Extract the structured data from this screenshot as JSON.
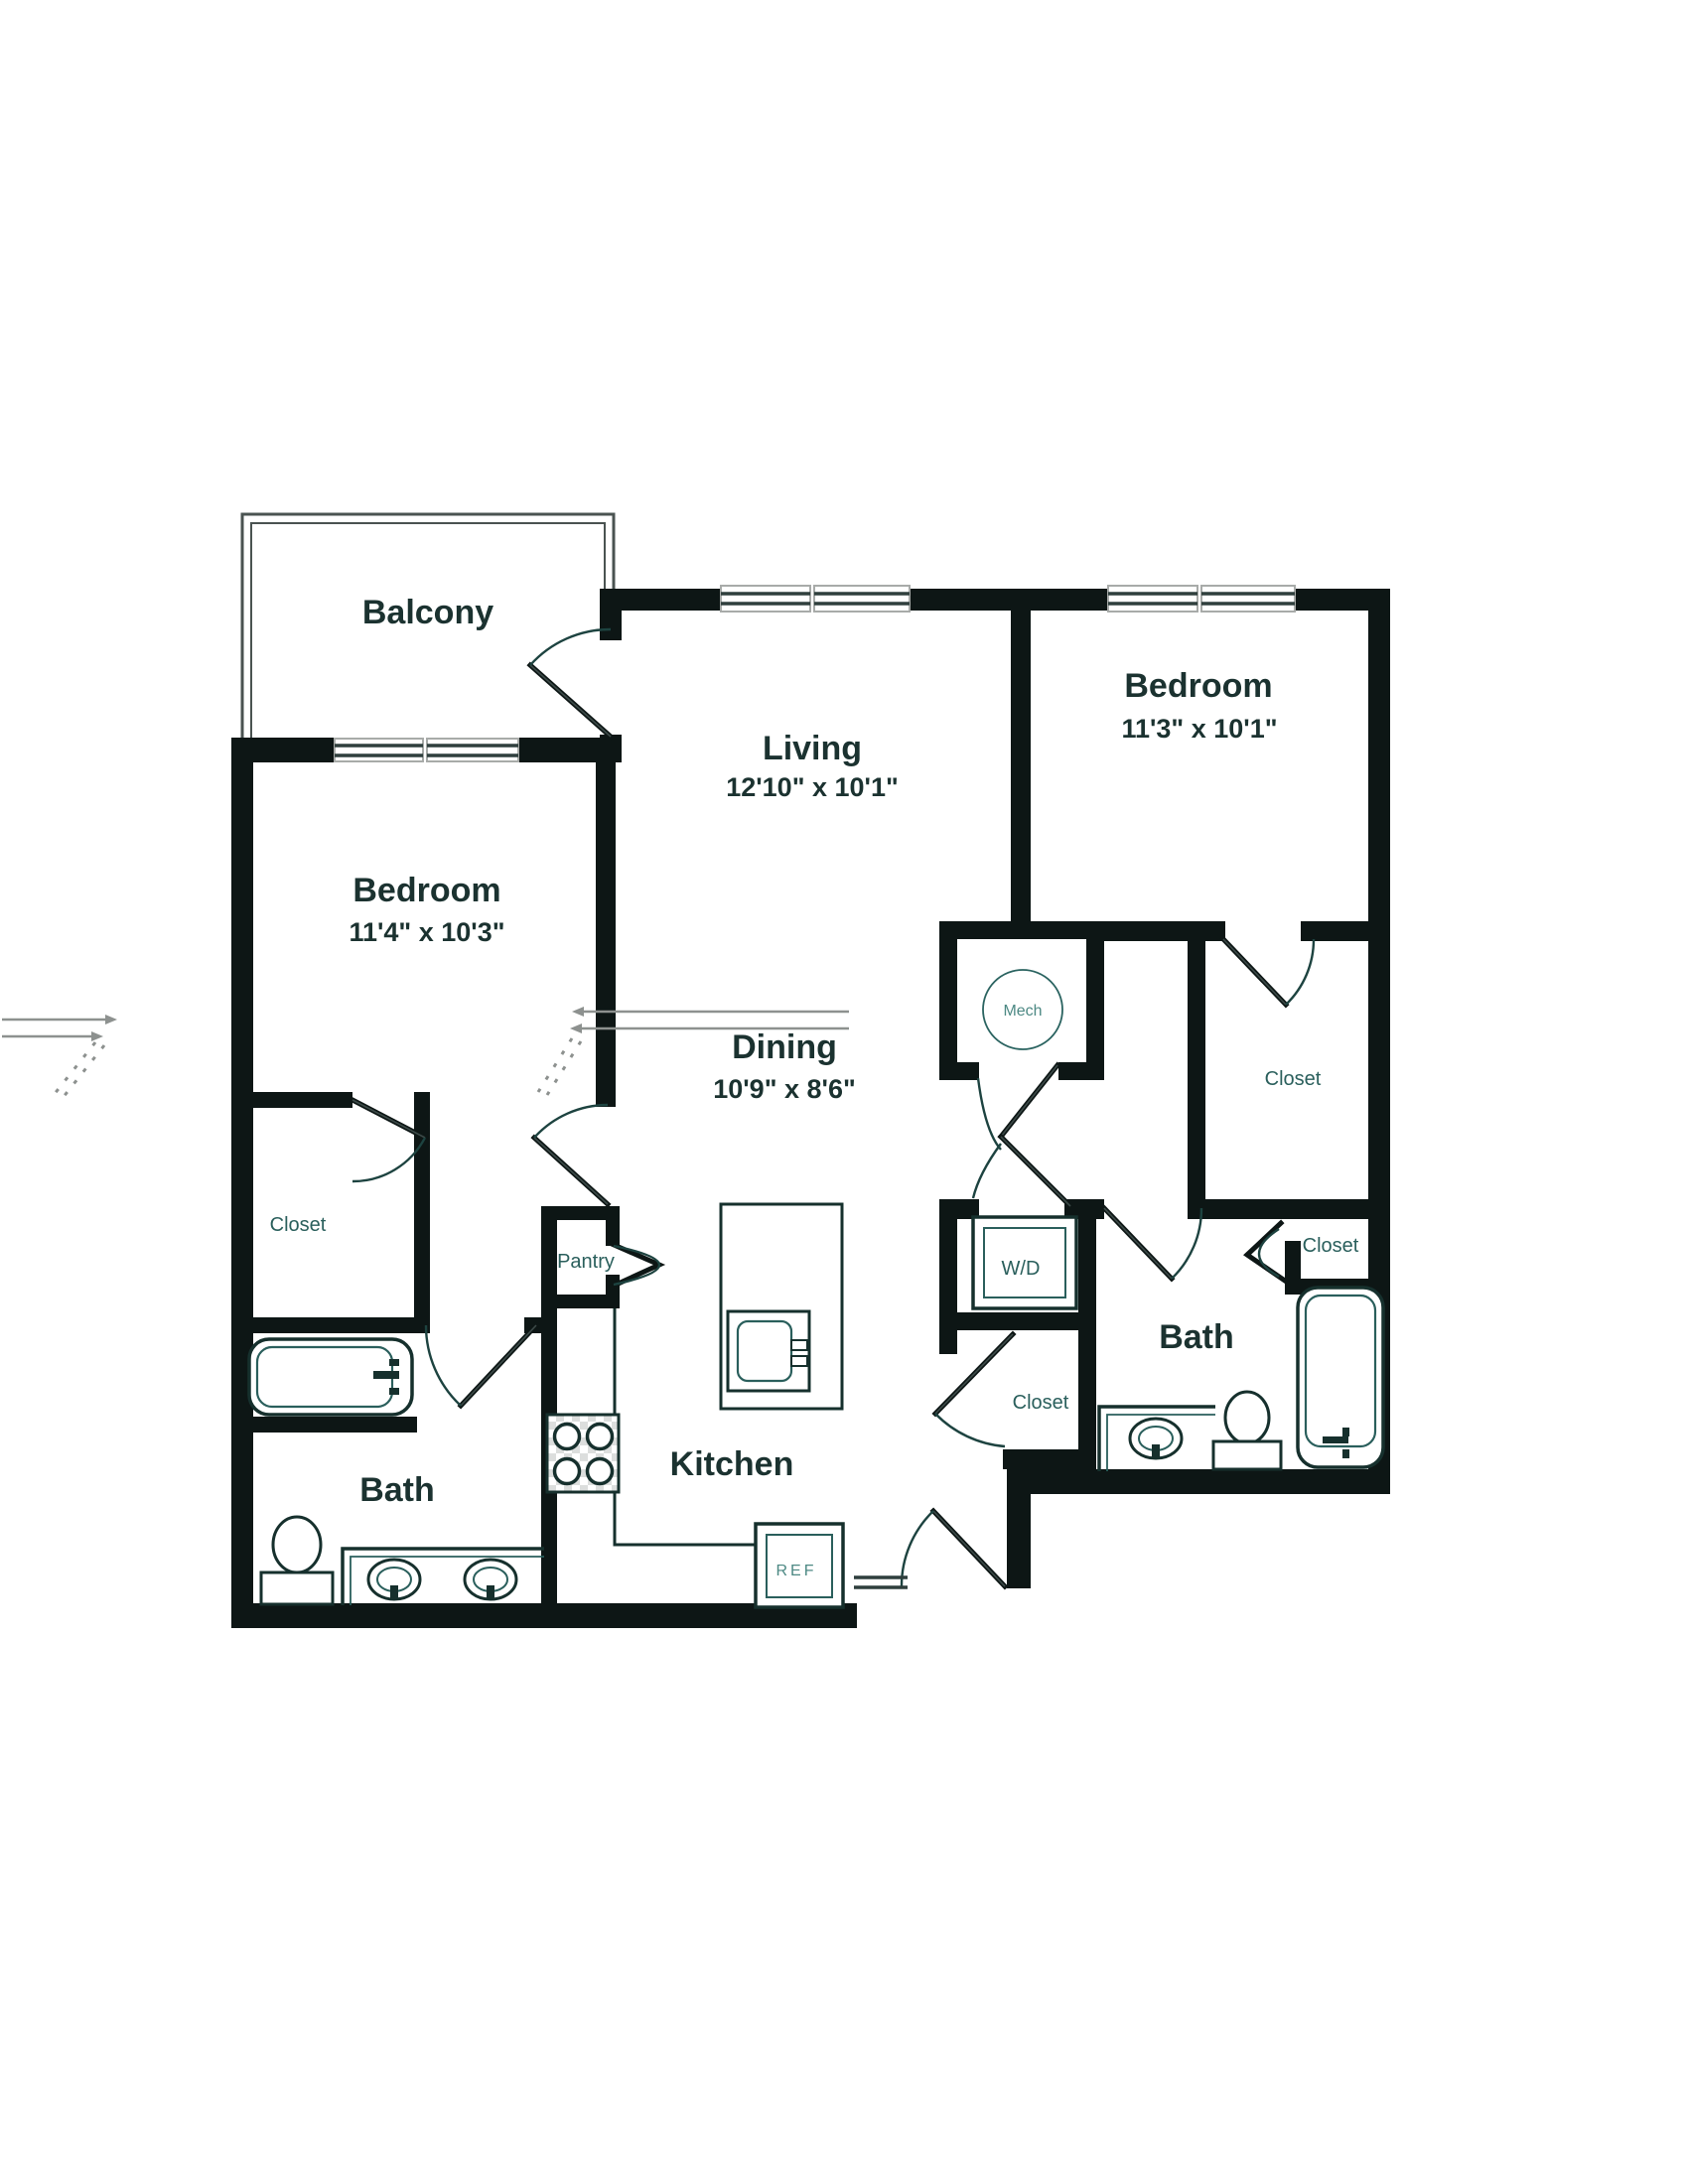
{
  "rooms": {
    "balcony": {
      "name": "Balcony"
    },
    "living": {
      "name": "Living",
      "dims": "12'10\" x 10'1\""
    },
    "bedroom_right": {
      "name": "Bedroom",
      "dims": "11'3\" x 10'1\""
    },
    "bedroom_left": {
      "name": "Bedroom",
      "dims": "11'4\" x 10'3\""
    },
    "dining": {
      "name": "Dining",
      "dims": "10'9\" x 8'6\""
    },
    "kitchen": {
      "name": "Kitchen"
    },
    "bath_left": {
      "name": "Bath"
    },
    "bath_right": {
      "name": "Bath"
    }
  },
  "features": {
    "closet_bedroom_left": "Closet",
    "closet_bedroom_right": "Closet",
    "closet_bath_right": "Closet",
    "closet_entry": "Closet",
    "pantry": "Pantry",
    "washer_dryer": "W/D",
    "mechanical": "Mech",
    "refrigerator": "REF"
  },
  "colors": {
    "wall": "#0d1615",
    "label_large": "#1b3230",
    "label_small": "#2a5f5c",
    "label_light": "#4d8984",
    "annotation_gray": "#8d918f",
    "background": "#ffffff"
  }
}
